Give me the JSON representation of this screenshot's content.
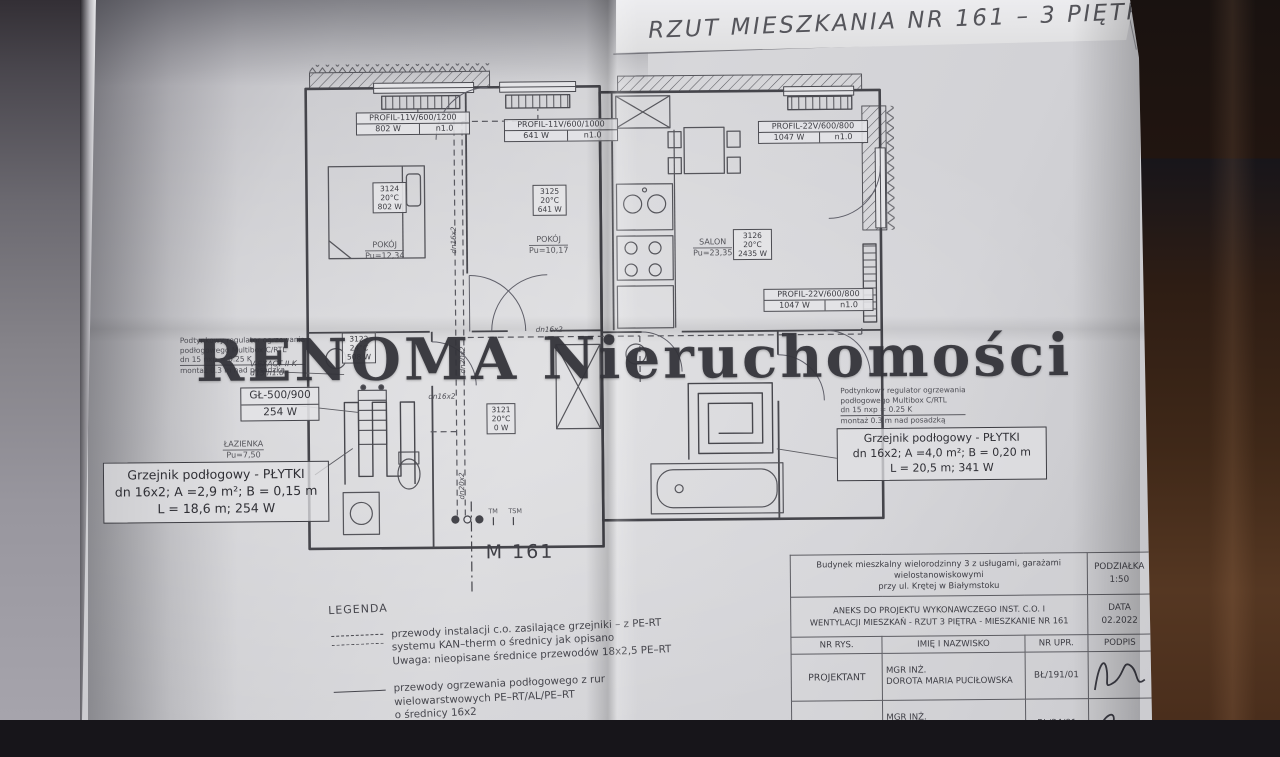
{
  "photo": {
    "title": "RZUT MIESZKANIA NR 161 – 3 PIĘTRO",
    "watermark": "RENOMA Nieruchomości",
    "unit_label": "M 161"
  },
  "colors": {
    "paper": "#d6d6d9",
    "ink": "#46464c",
    "backdrop_wood": "#4a2c1c"
  },
  "plan": {
    "radiator_labels": [
      {
        "model": "PROFIL-11V/600/1200",
        "power": "802 W",
        "flow": "n1.0"
      },
      {
        "model": "PROFIL-11V/600/1000",
        "power": "641 W",
        "flow": "n1.0"
      },
      {
        "model": "PROFIL-22V/600/800",
        "power": "1047 W",
        "flow": "n1.0"
      },
      {
        "model": "PROFIL-22V/600/800",
        "power": "1047 W",
        "flow": "n1.0"
      }
    ],
    "thermostats": [
      {
        "id": "3124",
        "temp": "20°C",
        "power": "802 W"
      },
      {
        "id": "3125",
        "temp": "20°C",
        "power": "641 W"
      },
      {
        "id": "3126",
        "temp": "20°C",
        "power": "2435 W"
      },
      {
        "id": "3121",
        "temp": "20°C",
        "power": "0 W"
      },
      {
        "id": "3122",
        "temp": "24°C",
        "power": "508 W"
      }
    ],
    "rooms": [
      {
        "name": "POKÓJ",
        "area": "Pu=12,34"
      },
      {
        "name": "POKÓJ",
        "area": "Pu=10,17"
      },
      {
        "name": "SALON",
        "area": "Pu=23,35"
      },
      {
        "name": "ŁAZIENKA",
        "area": "Pu=7,50"
      }
    ],
    "towel_radiator": {
      "model": "GŁ-500/900",
      "power": "254 W"
    },
    "valve_note": {
      "line1": "V-EXACT II K",
      "line2": "d15 n1.0"
    },
    "regulator_note": {
      "line1": "Podtynkowy regulator ogrzewania",
      "line2": "podłogowego Multibox C/RTL",
      "line3": "dn 15 nxp = 0.25 K",
      "line4": "montaż 0.3 m nad posadzką"
    },
    "floor_heating_left": {
      "line1": "Grzejnik podłogowy - PŁYTKI",
      "line2": "dn 16x2; A =2,9 m²; B = 0,15 m",
      "line3": "L = 18,6 m; 254 W"
    },
    "floor_heating_right": {
      "line1": "Grzejnik podłogowy - PŁYTKI",
      "line2": "dn 16x2; A =4,0 m²; B = 0,20 m",
      "line3": "L = 20,5 m; 341 W"
    },
    "pipe_labels": [
      "dn16x2",
      "dn20x2",
      "dn16x2",
      "dn16x2",
      "dn20x2"
    ],
    "riser_markers": {
      "tm": "TM",
      "tsm": "TSM"
    }
  },
  "legend": {
    "heading": "LEGENDA",
    "item1": {
      "line1": "przewody instalacji c.o. zasilające grzejniki – z PE-RT",
      "line2": "systemu KAN–therm o średnicy jak opisano",
      "line3": "Uwaga: nieopisane średnice przewodów 18x2,5 PE–RT"
    },
    "item2": {
      "line1": "przewody ogrzewania podłogowego z rur",
      "line2": "wielowarstwowych PE–RT/AL/PE–RT",
      "line3": "o średnicy 16x2"
    }
  },
  "titleblock": {
    "building_line1": "Budynek mieszkalny wielorodzinny 3 z usługami, garażami wielostanowiskowymi",
    "building_line2": "przy ul. Krętej w Białymstoku",
    "scale_label": "PODZIAŁKA",
    "scale_value": "1:50",
    "subject_line1": "ANEKS DO PROJEKTU WYKONAWCZEGO INST. C.O. I",
    "subject_line2": "WENTYLACJI MIESZKAŃ - RZUT 3 PIĘTRA - MIESZKANIE NR 161",
    "date_label": "DATA",
    "date_value": "02.2022",
    "col_headers": [
      "NR RYS.",
      "IMIĘ I NAZWISKO",
      "NR UPR.",
      "PODPIS"
    ],
    "rows": [
      {
        "role": "PROJEKTANT",
        "title": "MGR INŻ.",
        "name": "DOROTA MARIA PUCIŁOWSKA",
        "upr": "BŁ/191/01"
      },
      {
        "role": "SPRAWDZAJĄCY",
        "title": "MGR INŻ.",
        "name": "KRAWCZYK",
        "upr": "BŁ/34/01"
      }
    ]
  }
}
